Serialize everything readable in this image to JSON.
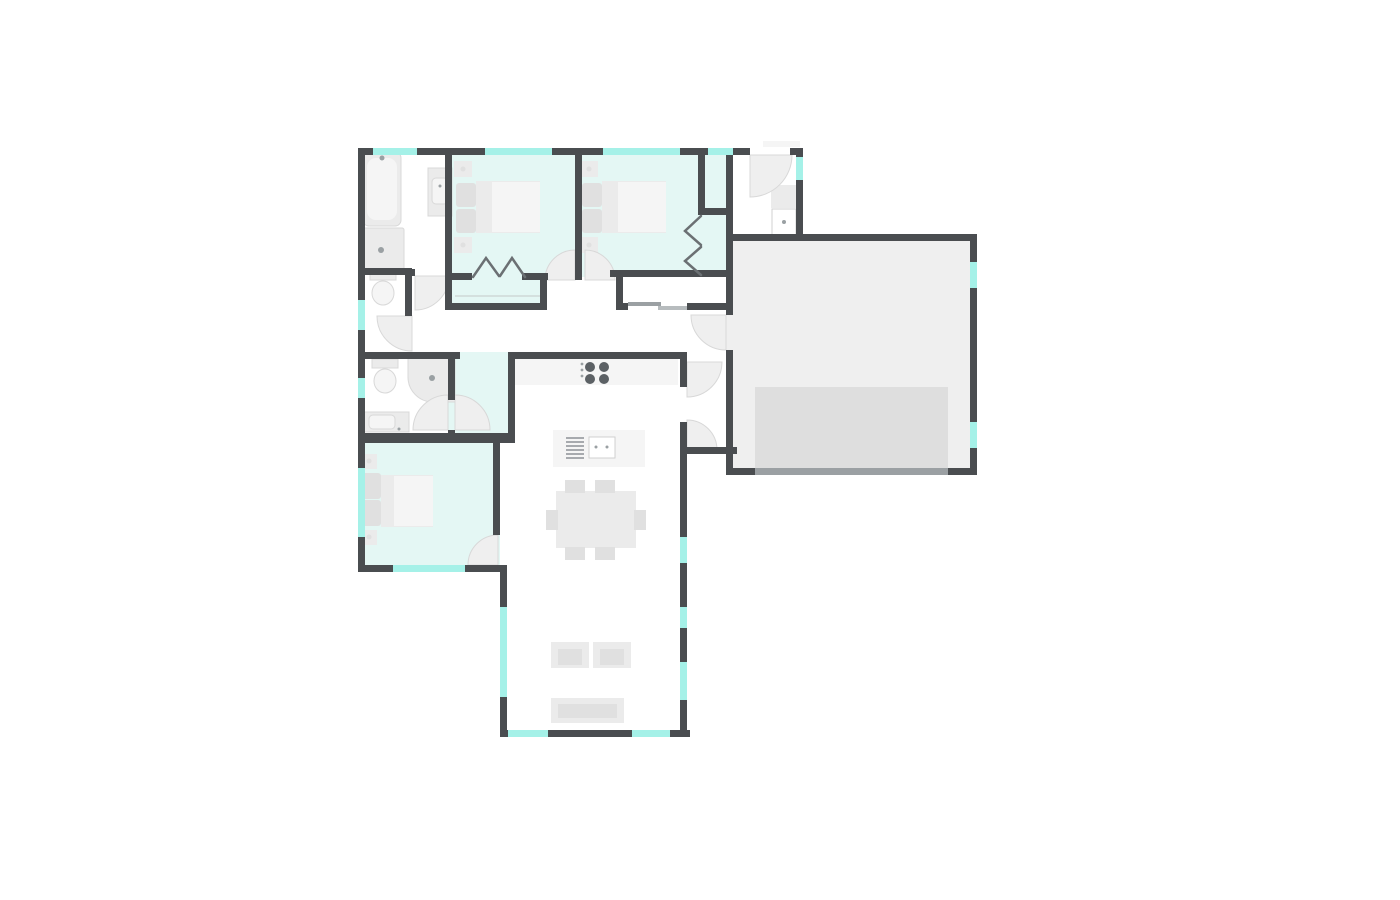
{
  "floorplan": {
    "colors": {
      "wall": "#4a4d50",
      "window": "#a5f1e8",
      "room_mint": "#e4f7f4",
      "room_white": "#ffffff",
      "garage_floor": "#efefef",
      "garage_pad": "#dedede",
      "furniture": "#ebebeb",
      "furniture_light": "#f5f5f5",
      "furniture_dark": "#e0e0e0",
      "door_arc": "#efefef",
      "garage_door": "#9ba0a3"
    },
    "rooms": [
      {
        "id": "bathroom-1",
        "floor": "white"
      },
      {
        "id": "wc-nook",
        "floor": "white"
      },
      {
        "id": "bedroom-1",
        "floor": "mint"
      },
      {
        "id": "bedroom-2",
        "floor": "mint"
      },
      {
        "id": "closet-strip",
        "floor": "mint"
      },
      {
        "id": "entry",
        "floor": "white"
      },
      {
        "id": "garage",
        "floor": "gray"
      },
      {
        "id": "hallway",
        "floor": "white"
      },
      {
        "id": "bathroom-2",
        "floor": "white"
      },
      {
        "id": "walk-in-vestibule",
        "floor": "mint"
      },
      {
        "id": "bedroom-3",
        "floor": "mint"
      },
      {
        "id": "living-kitchen",
        "floor": "white"
      }
    ],
    "fixtures": [
      "bathtub",
      "shower",
      "corner-shower",
      "toilet-1",
      "toilet-2",
      "vanity-sink-1",
      "vanity-sink-2",
      "entry-sink",
      "entry-mat",
      "double-bed-1",
      "double-bed-2",
      "double-bed-3",
      "nightstands",
      "bifold-closet-doors",
      "sliding-closet-doors",
      "kitchen-counter",
      "cooktop",
      "kitchen-island",
      "island-sink",
      "dishwasher",
      "dining-table",
      "dining-chairs",
      "armchairs",
      "tv-bench",
      "car-pad",
      "garage-door",
      "windows",
      "door-swings"
    ]
  }
}
